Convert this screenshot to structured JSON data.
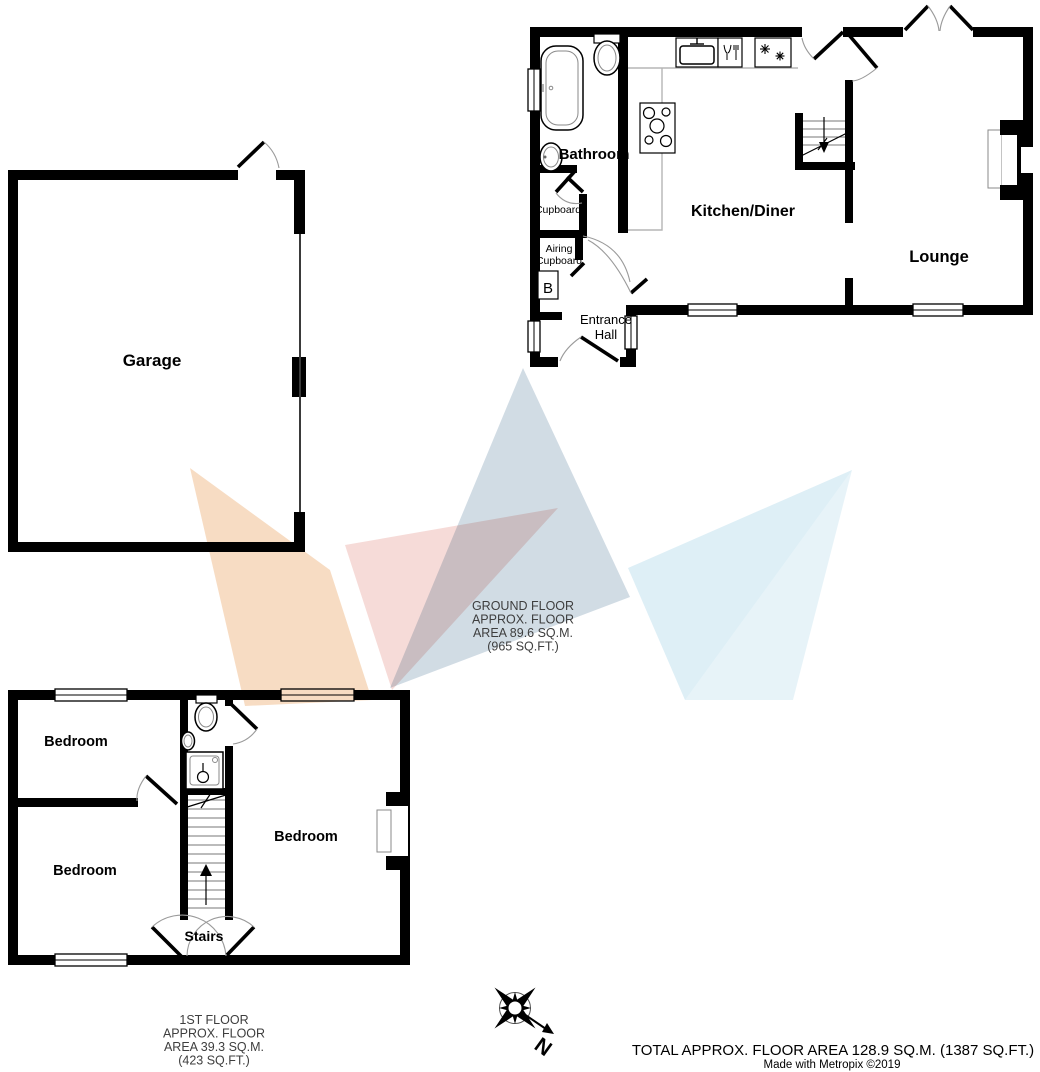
{
  "plan": {
    "garage": {
      "label": "Garage"
    },
    "ground_floor": {
      "bathroom": "Bathroom",
      "kitchen_diner": "Kitchen/Diner",
      "lounge": "Lounge",
      "cupboard": "Cupboard",
      "airing_line1": "Airing",
      "airing_line2": "Cupboard",
      "boiler": "B",
      "entrance_line1": "Entrance",
      "entrance_line2": "Hall",
      "caption": [
        "GROUND FLOOR",
        "APPROX. FLOOR",
        "AREA 89.6 SQ.M.",
        "(965 SQ.FT.)"
      ]
    },
    "first_floor": {
      "bedroom_top_left": "Bedroom",
      "bedroom_bottom_left": "Bedroom",
      "bedroom_right": "Bedroom",
      "stairs": "Stairs",
      "caption": [
        "1ST FLOOR",
        "APPROX. FLOOR",
        "AREA 39.3 SQ.M.",
        "(423 SQ.FT.)"
      ]
    },
    "compass": {
      "north": "N"
    },
    "footer": {
      "total": "TOTAL APPROX. FLOOR AREA 128.9 SQ.M. (1387 SQ.FT.)",
      "credit": "Made with Metropix ©2019"
    }
  },
  "colors": {
    "wall": "#000000",
    "watermark_orange": "#f7d9bd",
    "watermark_pink": "#eeb7b1",
    "watermark_gray_blue": "#c6d3de",
    "watermark_light_blue": "#d6ebf4",
    "watermark_pale_blue": "#cfe7f2",
    "caption_text": "#3e3e3e"
  }
}
